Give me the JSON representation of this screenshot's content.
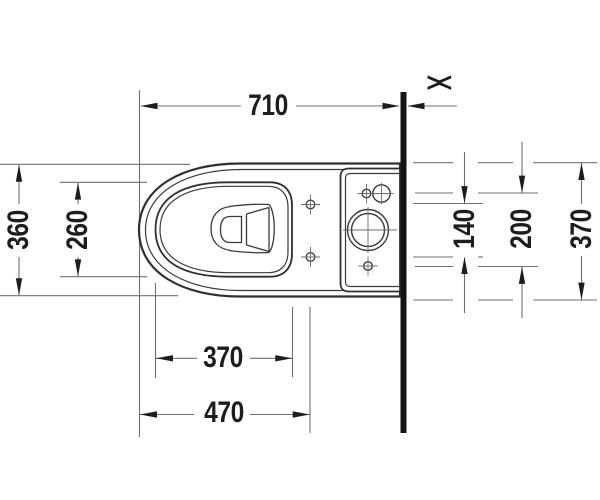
{
  "drawing_type": "technical-drawing-top-view",
  "product": "close-coupled-toilet-with-cistern-platform",
  "dims": {
    "total_depth": "710",
    "bowl_outer_width": "360",
    "bowl_inner_width": "260",
    "bowl_inner_length": "370",
    "front_to_seat_holes": "470",
    "seat_hole_spacing": "140",
    "tank_hole_spacing": "200",
    "rear_width": "370",
    "wall_gap_symbol": "><"
  },
  "colors": {
    "background": "#ffffff",
    "outline": "#2f2f2f",
    "thin_line": "#3a3a3a",
    "dimension_line": "#707070",
    "arrow_and_text": "#1d1d1d",
    "wall": "#141414"
  }
}
